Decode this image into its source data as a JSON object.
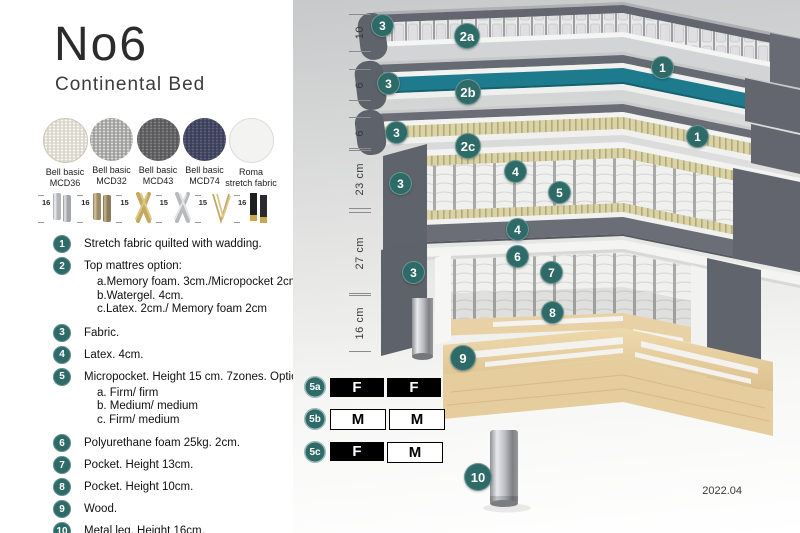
{
  "header": {
    "title": "No6",
    "subtitle": "Continental Bed"
  },
  "swatches": [
    {
      "line1": "Bell basic",
      "line2": "MCD36"
    },
    {
      "line1": "Bell basic",
      "line2": "MCD32"
    },
    {
      "line1": "Bell basic",
      "line2": "MCD43"
    },
    {
      "line1": "Bell basic",
      "line2": "MCD74"
    },
    {
      "line1": "Roma",
      "line2": "stretch fabric"
    }
  ],
  "legs": [
    {
      "height": "16",
      "type": "cylinder-silver-leg"
    },
    {
      "height": "16",
      "type": "cylinder-bronze-leg"
    },
    {
      "height": "15",
      "type": "cross-gold-leg"
    },
    {
      "height": "15",
      "type": "cross-silver-leg"
    },
    {
      "height": "15",
      "type": "hairpin-gold-leg"
    },
    {
      "height": "16",
      "type": "cylinder-black-gold-leg"
    }
  ],
  "features": [
    {
      "num": "1",
      "text": "Stretch fabric quilted with wadding."
    },
    {
      "num": "2",
      "text": "Top mattres option:",
      "options": [
        "a.Memory foam. 3cm./Micropocket 2cm",
        "b.Watergel. 4cm.",
        "c.Latex. 2cm./ Memory foam 2cm"
      ]
    },
    {
      "num": "3",
      "text": "Fabric."
    },
    {
      "num": "4",
      "text": "Latex. 4cm."
    },
    {
      "num": "5",
      "text": "Micropocket. Height 15 cm. 7zones. Option:",
      "options": [
        "a. Firm/ firm",
        "b. Medium/ medium",
        "c. Firm/ medium"
      ]
    },
    {
      "num": "6",
      "text": "Polyurethane foam 25kg. 2cm."
    },
    {
      "num": "7",
      "text": "Pocket. Height 13cm."
    },
    {
      "num": "8",
      "text": "Pocket. Height 10cm."
    },
    {
      "num": "9",
      "text": "Wood."
    },
    {
      "num": "10",
      "text": "Metal leg. Height 16cm."
    }
  ],
  "dimensions": [
    {
      "label": "10"
    },
    {
      "label": "6"
    },
    {
      "label": "6"
    },
    {
      "label": "23 cm"
    },
    {
      "label": "27 cm"
    },
    {
      "label": "16 cm"
    }
  ],
  "callouts": [
    {
      "label": "3"
    },
    {
      "label": "2a"
    },
    {
      "label": "1"
    },
    {
      "label": "3"
    },
    {
      "label": "2b"
    },
    {
      "label": "1"
    },
    {
      "label": "3"
    },
    {
      "label": "2c"
    },
    {
      "label": "4"
    },
    {
      "label": "5"
    },
    {
      "label": "3"
    },
    {
      "label": "4"
    },
    {
      "label": "6"
    },
    {
      "label": "7"
    },
    {
      "label": "3"
    },
    {
      "label": "8"
    },
    {
      "label": "9"
    },
    {
      "label": "10"
    }
  ],
  "firmness": {
    "rows": [
      {
        "id": "5a",
        "cells": [
          {
            "text": "F",
            "variant": "dark"
          },
          {
            "text": "F",
            "variant": "dark"
          }
        ]
      },
      {
        "id": "5b",
        "cells": [
          {
            "text": "M",
            "variant": "light"
          },
          {
            "text": "M",
            "variant": "light"
          }
        ]
      },
      {
        "id": "5c",
        "cells": [
          {
            "text": "F",
            "variant": "dark"
          },
          {
            "text": "M",
            "variant": "light"
          }
        ]
      }
    ]
  },
  "footer": {
    "version": "2022.04"
  },
  "colors": {
    "accent_teal": "#2E6B68",
    "watergel_teal": "#1E7B8E",
    "fabric_gray": "#686C74",
    "latex_yellow": "#D9D3A6",
    "wood_tan": "#E7CFA1",
    "black_cell": "#000000"
  }
}
